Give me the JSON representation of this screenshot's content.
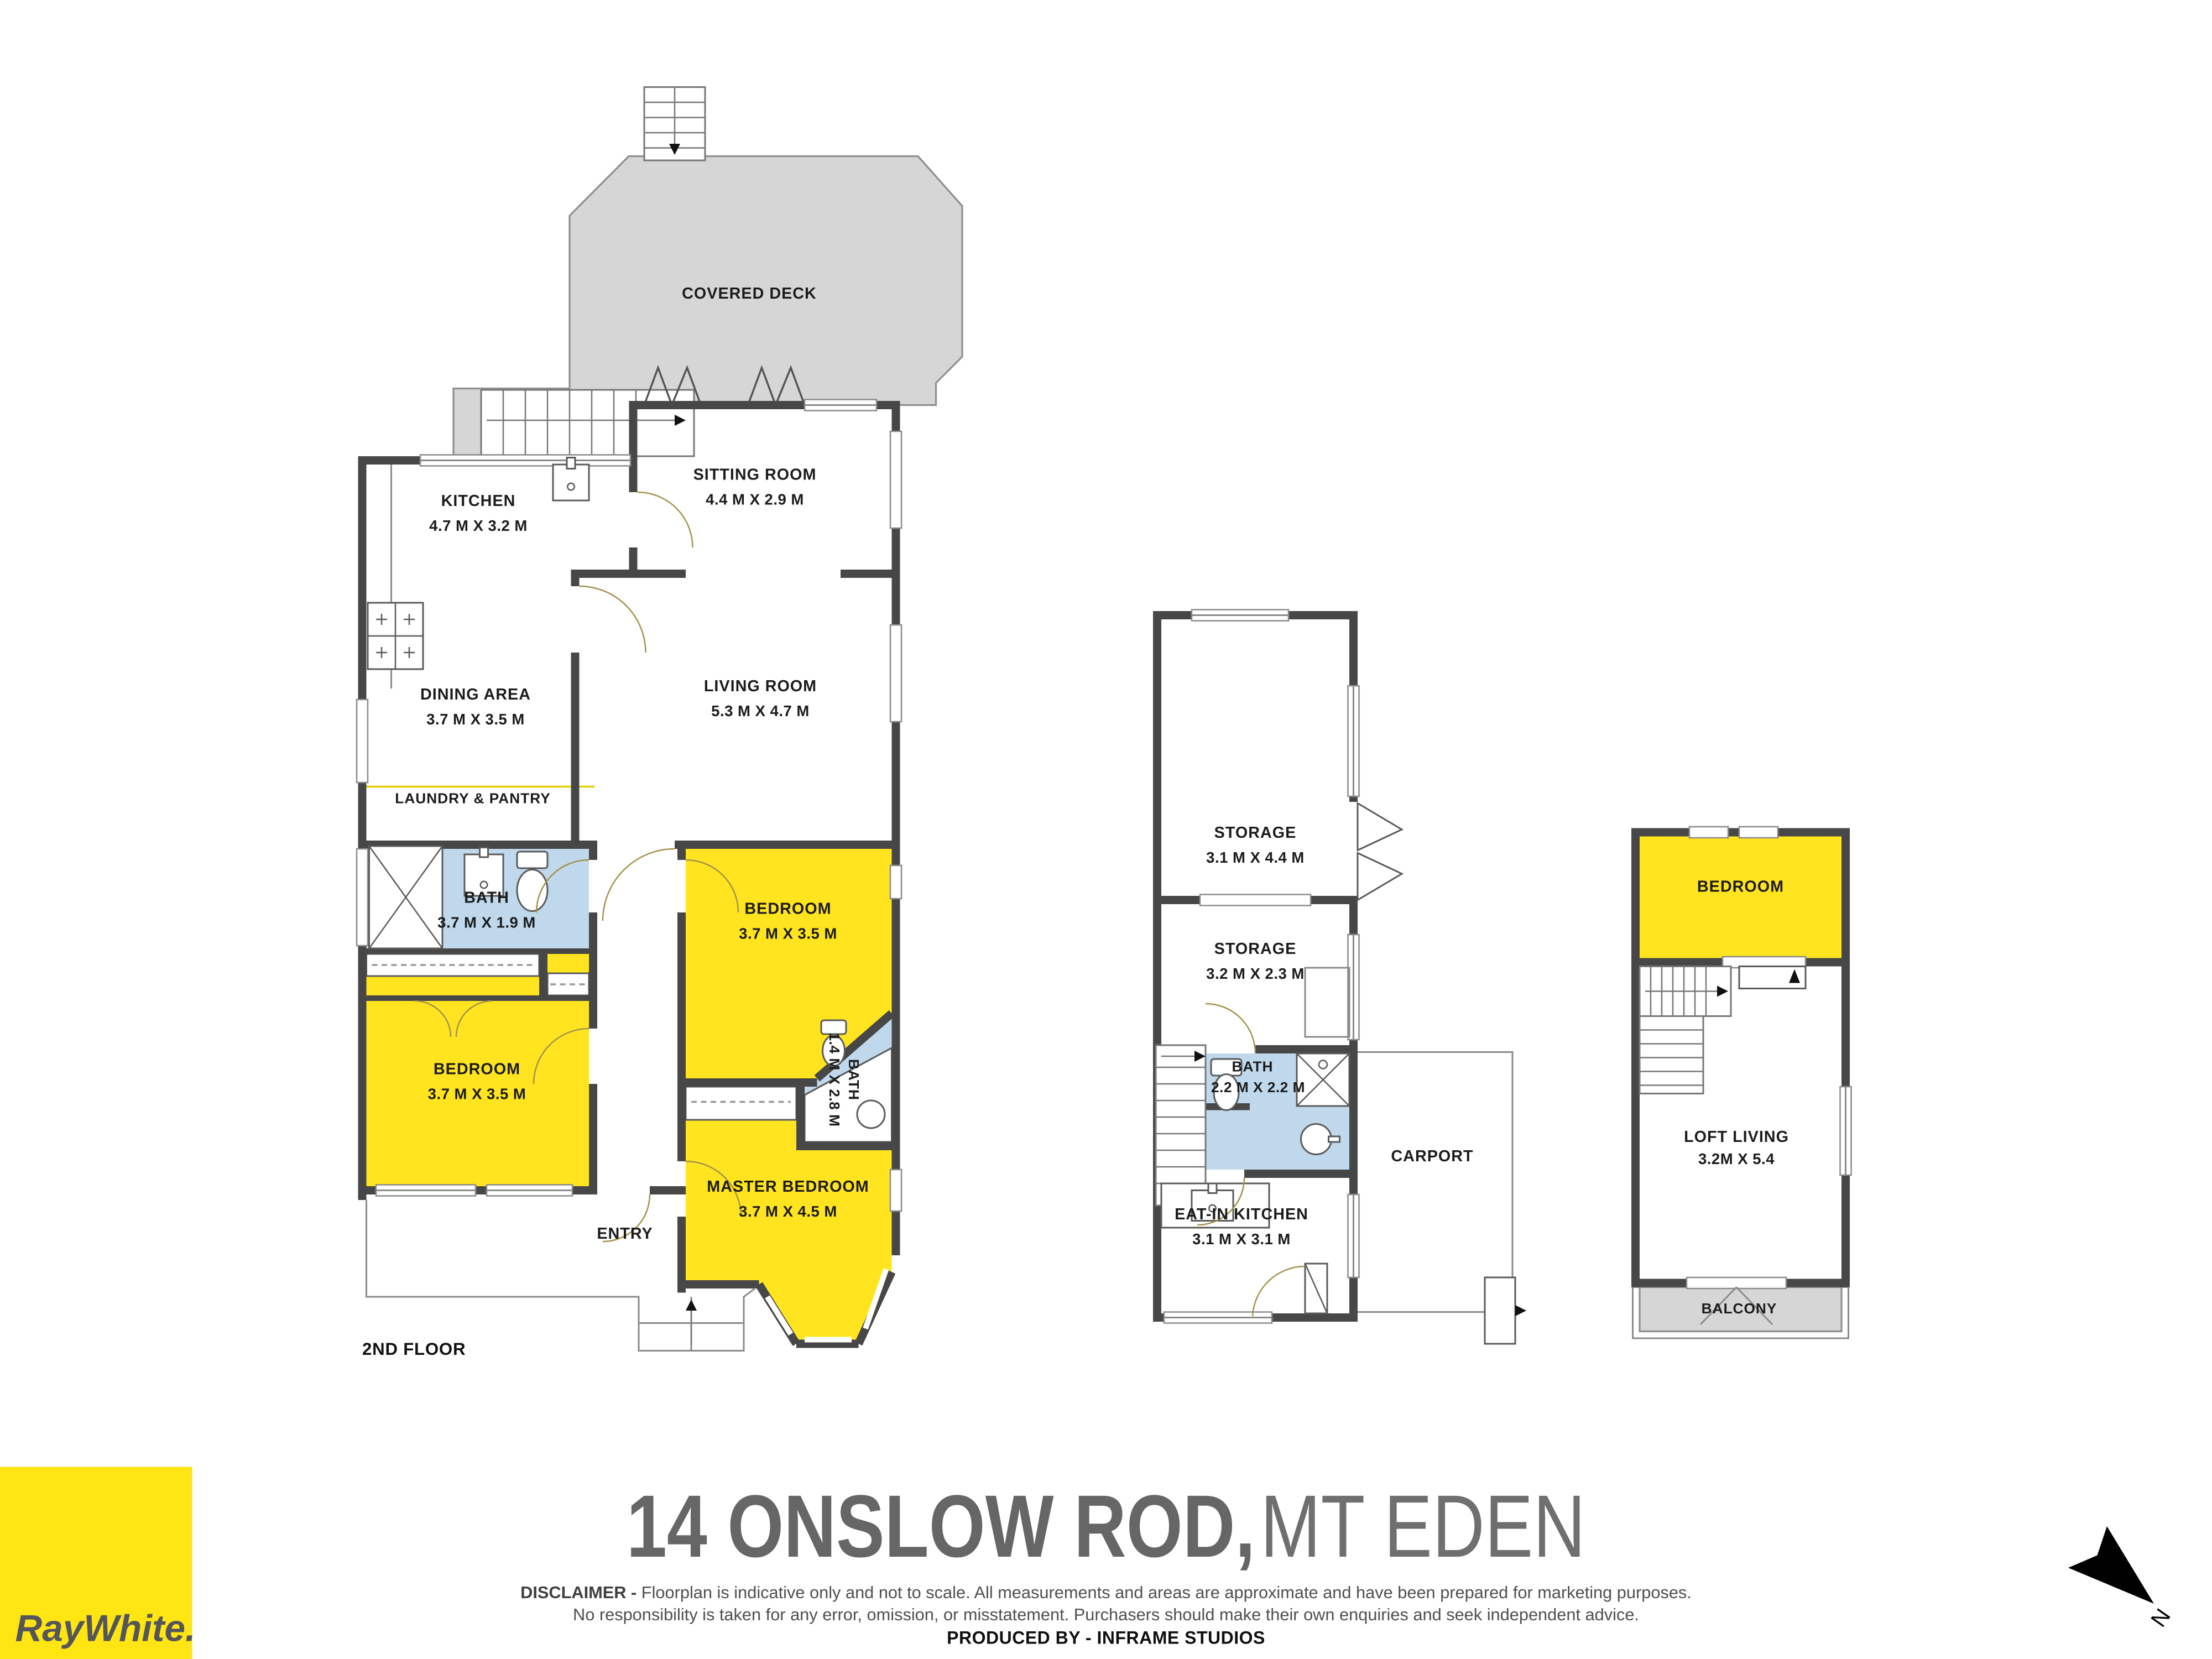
{
  "colors": {
    "accent_yellow": "#FFE512",
    "room_yellow": "#FFE41F",
    "bath_blue": "#BFD8EC",
    "wall_gray": "#474747",
    "deck_gray": "#D6D6D6",
    "title_gray": "#666666"
  },
  "plans": {
    "main": {
      "floor_label": "2ND FLOOR",
      "deck": {
        "label": "COVERED DECK"
      },
      "rooms": {
        "sitting": {
          "name": "SITTING ROOM",
          "dims": "4.4 M X 2.9 M"
        },
        "kitchen": {
          "name": "KITCHEN",
          "dims": "4.7 M X 3.2 M"
        },
        "dining": {
          "name": "DINING AREA",
          "dims": "3.7 M X 3.5 M"
        },
        "living": {
          "name": "LIVING ROOM",
          "dims": "5.3 M X 4.7 M"
        },
        "laundry": {
          "name": "LAUNDRY & PANTRY"
        },
        "bath": {
          "name": "BATH",
          "dims": "3.7 M X 1.9 M"
        },
        "bedroom_rear": {
          "name": "BEDROOM",
          "dims": "3.7 M X 3.5 M"
        },
        "bedroom_front": {
          "name": "BEDROOM",
          "dims": "3.7 M X 3.5 M"
        },
        "ensuite": {
          "name": "BATH",
          "dims": "1.4 M X 2.8 M"
        },
        "master": {
          "name": "MASTER BEDROOM",
          "dims": "3.7 M X 4.5 M"
        },
        "entry": {
          "name": "ENTRY"
        }
      }
    },
    "garage": {
      "rooms": {
        "storage_large": {
          "name": "STORAGE",
          "dims": "3.1 M X 4.4 M"
        },
        "storage_small": {
          "name": "STORAGE",
          "dims": "3.2 M X 2.3 M"
        },
        "bath": {
          "name": "BATH",
          "dims": "2.2 M X 2.2 M"
        },
        "eat_in_kitchen": {
          "name": "EAT-IN KITCHEN",
          "dims": "3.1 M X 3.1 M"
        },
        "carport": {
          "name": "CARPORT"
        }
      }
    },
    "loft": {
      "rooms": {
        "bedroom": {
          "name": "BEDROOM"
        },
        "loft_living": {
          "name": "LOFT LIVING",
          "dims": "3.2M X 5.4"
        },
        "balcony": {
          "name": "BALCONY"
        }
      }
    }
  },
  "footer": {
    "address_primary": "14 ONSLOW ROD,",
    "address_secondary": " MT EDEN",
    "disclaimer_label": "DISCLAIMER - ",
    "disclaimer_line1": "Floorplan is indicative only and not to scale. All measurements and areas are approximate and have been prepared for marketing purposes.",
    "disclaimer_line2": "No responsibility is taken for any error, omission, or misstatement. Purchasers should make their own enquiries and seek independent advice.",
    "produced_by": "PRODUCED BY - INFRAME STUDIOS"
  },
  "brand": {
    "logo_text": "RayWhite."
  },
  "compass": {
    "north_label": "N"
  }
}
